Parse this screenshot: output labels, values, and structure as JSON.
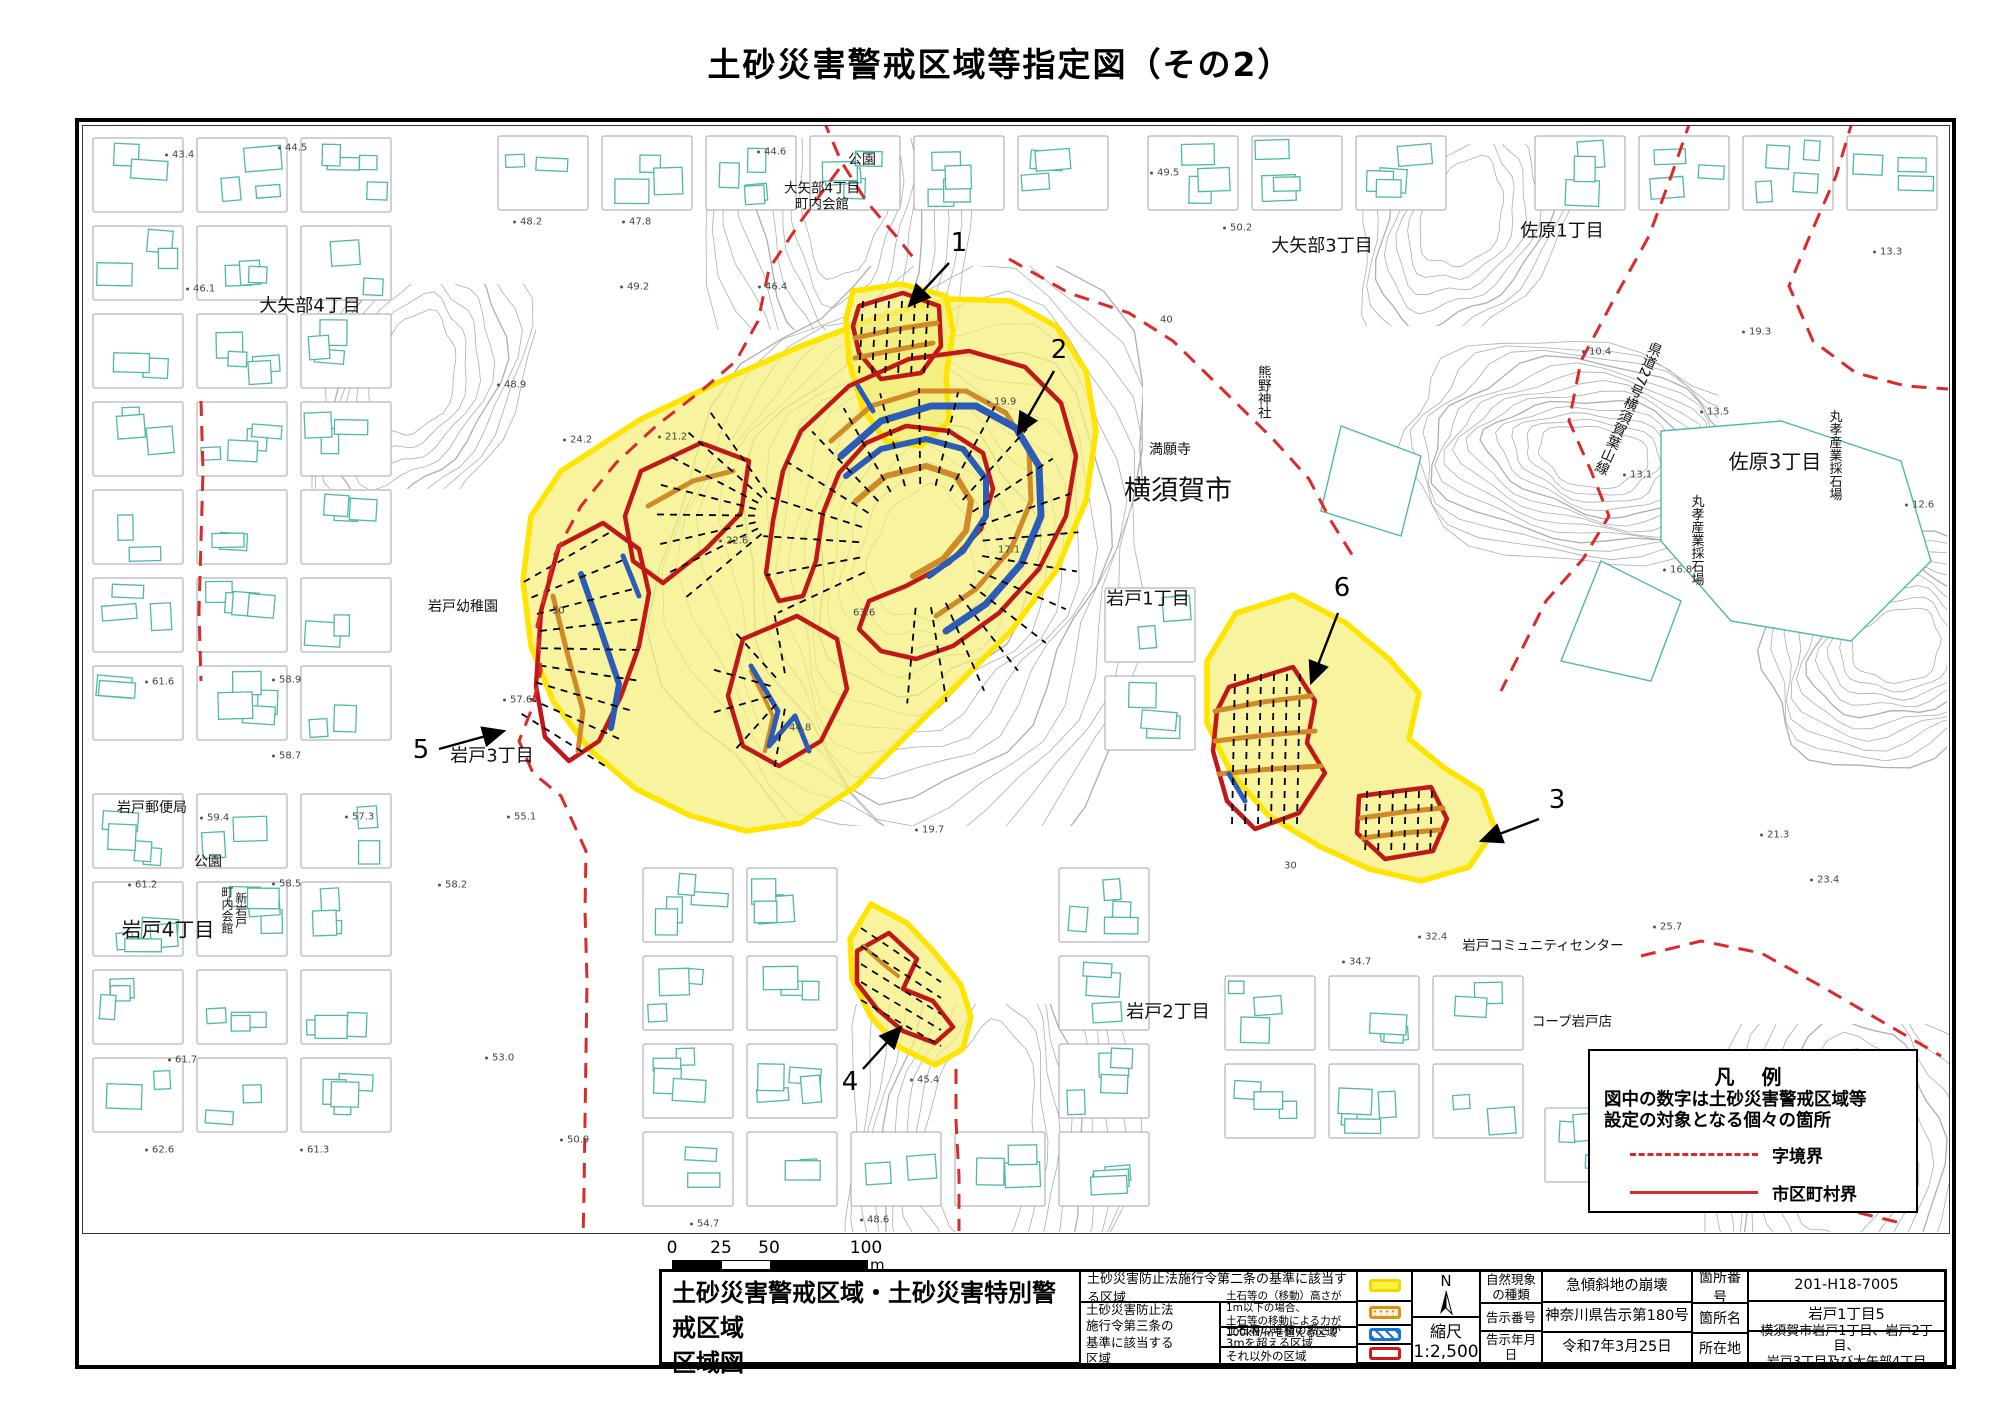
{
  "doc": {
    "title": "土砂災害警戒区域等指定図（その2）"
  },
  "colors": {
    "warning_yellow_fill": "#F4EF7C",
    "warning_yellow_line": "#FFE400",
    "special_red": "#C01818",
    "deposit_blue": "#2A5CB8",
    "movement_orange": "#D08A28",
    "boundary_red_dash": "#D92B2B",
    "building_teal": "#4FB8A8",
    "parcel_gray": "#A3A3A3",
    "contour_gray": "#A6ABAB"
  },
  "scalebar": {
    "ticks": [
      "0",
      "25",
      "50",
      "100"
    ],
    "unit": "m"
  },
  "legend_panel": {
    "title": "凡 例",
    "line1": "図中の数字は土砂災害警戒区域等",
    "line2": "設定の対象となる個々の箇所",
    "dashed_label": "字境界",
    "solid_label": "市区町村界"
  },
  "table": {
    "title": "土砂災害警戒区域・土砂災害特別警戒区域\n区域図",
    "article2_row": "土砂災害防止法施行令第二条の基準に該当する区域",
    "article3_header": "土砂災害防止法\n施行令第三条の\n基準に該当する\n区域",
    "article3_row1": "土石等の（移動）高さが1m以下の場合、\n土石等の移動による力が100kN/㎡を超える区域",
    "article3_row2": "土石等の堆積の高さが3mを超える区域",
    "article3_row3": "それ以外の区域",
    "compass_n": "N",
    "scale_label": "縮尺",
    "scale_value": "1:2,500",
    "info": [
      {
        "label": "自然現象\nの種類",
        "value": "急傾斜地の崩壊"
      },
      {
        "label": "告示番号",
        "value": "神奈川県告示第180号"
      },
      {
        "label": "告示年月日",
        "value": "令和7年3月25日"
      }
    ],
    "info2": [
      {
        "label": "箇所番号",
        "value": "201-H18-7005"
      },
      {
        "label": "箇所名",
        "value": "岩戸1丁目5"
      },
      {
        "label": "所在地",
        "value": "横須賀市岩戸1丁目、岩戸2丁目、\n岩戸3丁目及び大矢部4丁目"
      }
    ]
  },
  "map": {
    "labels": [
      {
        "id": "oyabe4",
        "text": "大矢部4丁目",
        "x": 310,
        "y": 307,
        "size": 18
      },
      {
        "id": "park-top",
        "text": "公園",
        "x": 862,
        "y": 160,
        "size": 14
      },
      {
        "id": "kaikan-top",
        "text": "大矢部4丁目\n町内会館",
        "x": 822,
        "y": 197,
        "size": 13.5
      },
      {
        "id": "oyabe3",
        "text": "大矢部3丁目",
        "x": 1322,
        "y": 247,
        "size": 18
      },
      {
        "id": "sahara1",
        "text": "佐原1丁目",
        "x": 1562,
        "y": 232,
        "size": 18
      },
      {
        "id": "kumano",
        "text": "熊野神社",
        "x": 1262,
        "y": 392,
        "size": 13.5,
        "vertical": true
      },
      {
        "id": "mangan",
        "text": "満願寺",
        "x": 1170,
        "y": 450,
        "size": 14
      },
      {
        "id": "yokosuka",
        "text": "横須賀市",
        "x": 1178,
        "y": 491,
        "size": 27
      },
      {
        "id": "iwato1",
        "text": "岩戸1丁目",
        "x": 1148,
        "y": 600,
        "size": 18
      },
      {
        "id": "sahara3",
        "text": "佐原3丁目",
        "x": 1775,
        "y": 462,
        "size": 20
      },
      {
        "id": "quarry-a",
        "text": "丸孝産業採石場",
        "x": 1833,
        "y": 455,
        "size": 13,
        "vertical": true
      },
      {
        "id": "quarry-b",
        "text": "丸孝産業採石場",
        "x": 1695,
        "y": 540,
        "size": 13,
        "vertical": true
      },
      {
        "id": "kendo27",
        "text": "県道27号横須賀葉山線",
        "x": 1628,
        "y": 408,
        "size": 14,
        "vertical": true,
        "rotate": 24
      },
      {
        "id": "kindergarten",
        "text": "岩戸幼稚園",
        "x": 463,
        "y": 607,
        "size": 14
      },
      {
        "id": "postoffice",
        "text": "岩戸郵便局",
        "x": 152,
        "y": 808,
        "size": 14
      },
      {
        "id": "park-left",
        "text": "公園",
        "x": 208,
        "y": 862,
        "size": 14
      },
      {
        "id": "shin-iwato",
        "text": "新岩戸\n町内会館",
        "x": 233,
        "y": 910,
        "size": 12,
        "vertical": true
      },
      {
        "id": "iwato4",
        "text": "岩戸4丁目",
        "x": 168,
        "y": 930,
        "size": 20
      },
      {
        "id": "iwato3",
        "text": "岩戸3丁目",
        "x": 492,
        "y": 757,
        "size": 18
      },
      {
        "id": "iwato2",
        "text": "岩戸2丁目",
        "x": 1168,
        "y": 1013,
        "size": 18
      },
      {
        "id": "community",
        "text": "岩戸コミュニティセンター",
        "x": 1543,
        "y": 947,
        "size": 13.5
      },
      {
        "id": "coop",
        "text": "コープ岩戸店",
        "x": 1572,
        "y": 1023,
        "size": 13.5
      }
    ],
    "area_markers": [
      {
        "n": "1",
        "tx": 959,
        "ty": 243,
        "x1": 948,
        "y1": 262,
        "x2": 908,
        "y2": 305
      },
      {
        "n": "2",
        "tx": 1059,
        "ty": 350,
        "x1": 1053,
        "y1": 370,
        "x2": 1017,
        "y2": 433
      },
      {
        "n": "3",
        "tx": 1557,
        "ty": 800,
        "x1": 1538,
        "y1": 818,
        "x2": 1480,
        "y2": 840
      },
      {
        "n": "4",
        "tx": 850,
        "ty": 1082,
        "x1": 862,
        "y1": 1068,
        "x2": 900,
        "y2": 1026
      },
      {
        "n": "5",
        "tx": 421,
        "ty": 750,
        "x1": 438,
        "y1": 748,
        "x2": 503,
        "y2": 730
      },
      {
        "n": "6",
        "tx": 1342,
        "ty": 588,
        "x1": 1337,
        "y1": 612,
        "x2": 1310,
        "y2": 682
      }
    ],
    "spot_elevations": [
      {
        "x": 165,
        "y": 155,
        "v": "43.4"
      },
      {
        "x": 278,
        "y": 148,
        "v": "44.5"
      },
      {
        "x": 757,
        "y": 152,
        "v": "44.6"
      },
      {
        "x": 513,
        "y": 222,
        "v": "48.2"
      },
      {
        "x": 622,
        "y": 222,
        "v": "47.8"
      },
      {
        "x": 186,
        "y": 289,
        "v": "46.1"
      },
      {
        "x": 620,
        "y": 287,
        "v": "49.2"
      },
      {
        "x": 758,
        "y": 287,
        "v": "46.4"
      },
      {
        "x": 1150,
        "y": 173,
        "v": "49.5"
      },
      {
        "x": 1223,
        "y": 228,
        "v": "50.2"
      },
      {
        "x": 497,
        "y": 385,
        "v": "48.9"
      },
      {
        "x": 563,
        "y": 440,
        "v": "24.2"
      },
      {
        "x": 658,
        "y": 437,
        "v": "21.2"
      },
      {
        "x": 719,
        "y": 541,
        "v": "22.6"
      },
      {
        "x": 853,
        "y": 613,
        "v": "63.6",
        "dot": false
      },
      {
        "x": 998,
        "y": 550,
        "v": "17.1",
        "dot": false
      },
      {
        "x": 782,
        "y": 728,
        "v": "44.8"
      },
      {
        "x": 915,
        "y": 830,
        "v": "19.7"
      },
      {
        "x": 987,
        "y": 402,
        "v": "19.9"
      },
      {
        "x": 1582,
        "y": 352,
        "v": "10.4"
      },
      {
        "x": 1742,
        "y": 332,
        "v": "19.3"
      },
      {
        "x": 1700,
        "y": 412,
        "v": "13.5"
      },
      {
        "x": 1623,
        "y": 475,
        "v": "13.1"
      },
      {
        "x": 1663,
        "y": 570,
        "v": "16.8"
      },
      {
        "x": 1873,
        "y": 252,
        "v": "13.3"
      },
      {
        "x": 1905,
        "y": 505,
        "v": "12.6"
      },
      {
        "x": 145,
        "y": 682,
        "v": "61.6"
      },
      {
        "x": 272,
        "y": 680,
        "v": "58.9"
      },
      {
        "x": 272,
        "y": 756,
        "v": "58.7"
      },
      {
        "x": 200,
        "y": 818,
        "v": "59.4"
      },
      {
        "x": 345,
        "y": 817,
        "v": "57.3"
      },
      {
        "x": 507,
        "y": 817,
        "v": "55.1"
      },
      {
        "x": 128,
        "y": 885,
        "v": "61.2"
      },
      {
        "x": 272,
        "y": 884,
        "v": "58.5"
      },
      {
        "x": 438,
        "y": 885,
        "v": "58.2"
      },
      {
        "x": 503,
        "y": 700,
        "v": "57.6"
      },
      {
        "x": 168,
        "y": 1060,
        "v": "61.7"
      },
      {
        "x": 485,
        "y": 1058,
        "v": "53.0"
      },
      {
        "x": 560,
        "y": 1140,
        "v": "50.9"
      },
      {
        "x": 145,
        "y": 1150,
        "v": "62.6"
      },
      {
        "x": 300,
        "y": 1150,
        "v": "61.3"
      },
      {
        "x": 690,
        "y": 1224,
        "v": "54.7"
      },
      {
        "x": 860,
        "y": 1220,
        "v": "48.6"
      },
      {
        "x": 1418,
        "y": 937,
        "v": "32.4"
      },
      {
        "x": 1342,
        "y": 962,
        "v": "34.7"
      },
      {
        "x": 1653,
        "y": 927,
        "v": "25.7"
      },
      {
        "x": 1810,
        "y": 880,
        "v": "23.4"
      },
      {
        "x": 1760,
        "y": 835,
        "v": "21.3"
      },
      {
        "x": 910,
        "y": 1080,
        "v": "45.4"
      },
      {
        "x": 552,
        "y": 611,
        "v": "50",
        "dot": false
      },
      {
        "x": 1160,
        "y": 320,
        "v": "40",
        "dot": false
      },
      {
        "x": 1284,
        "y": 866,
        "v": "30",
        "dot": false
      }
    ]
  }
}
